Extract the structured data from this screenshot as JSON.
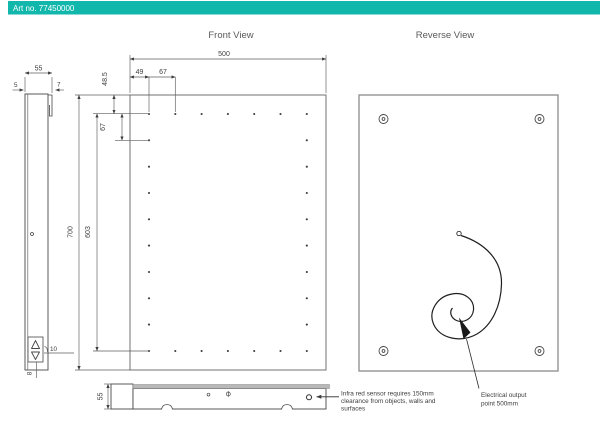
{
  "header": {
    "title": "Art no. 77450000"
  },
  "front_view": {
    "title": "Front View",
    "dims": {
      "width": "500",
      "height": "700",
      "grid_height": "603",
      "top_offset": "48.5",
      "left_offset": "49",
      "col_gap": "67",
      "row_gap": "67"
    },
    "led_grid": {
      "cols": 7,
      "rows": 10
    }
  },
  "side_view": {
    "dims": {
      "depth": "55",
      "glass_thickness": "5",
      "bracket_thickness": "7",
      "switch_offset": "10",
      "switch_width": "8"
    }
  },
  "bottom_view": {
    "dims": {
      "depth": "55"
    }
  },
  "reverse_view": {
    "title": "Reverse View"
  },
  "annotations": {
    "infra_red": {
      "line1": "Infra red sensor requires 150mm",
      "line2": "clearance from objects, walls and",
      "line3": "surfaces"
    },
    "electrical": {
      "line1": "Electrical output",
      "line2": "point 500mm"
    }
  },
  "colors": {
    "header_bg": "#12b7ac",
    "annotation_red": "#e8504d"
  }
}
